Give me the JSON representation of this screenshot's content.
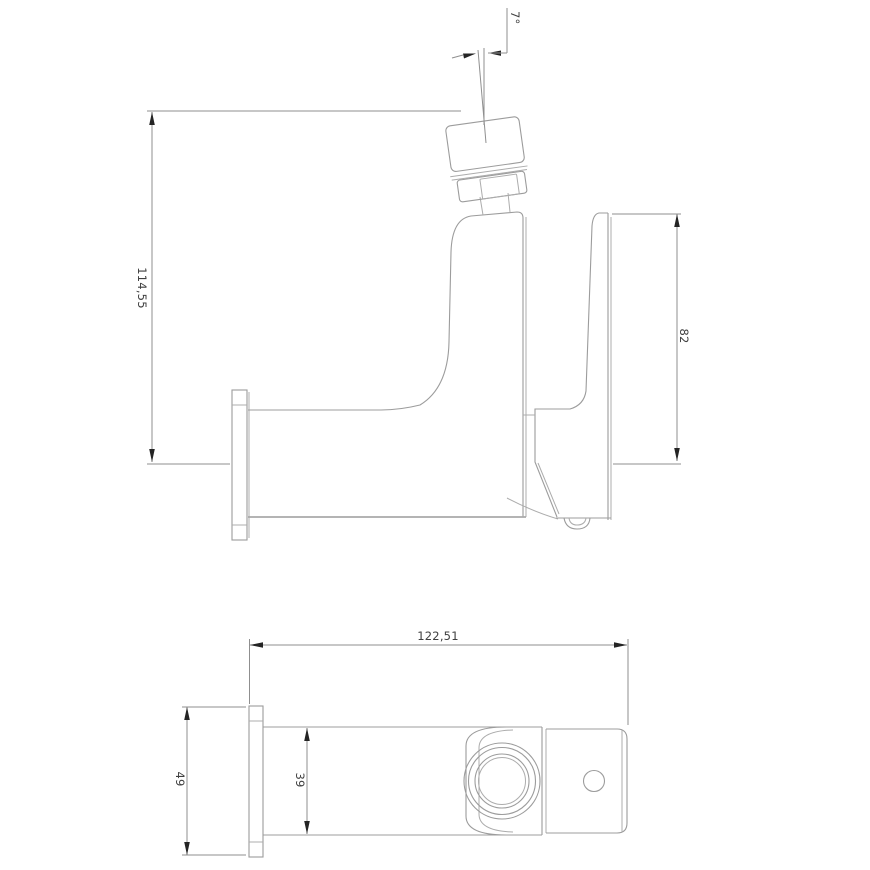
{
  "drawing": {
    "type": "technical-drawing-faucet",
    "colors": {
      "background": "#ffffff",
      "geometry_line": "#9c9c9c",
      "dimension_line": "#8f8f8f",
      "arrow": "#242424",
      "text": "#3f3f3f"
    },
    "side_view": {
      "overall_height": "114,55",
      "handle_height": "82",
      "aerator_angle": "7°"
    },
    "top_view": {
      "overall_length": "122,51",
      "flange_width": "49",
      "body_width": "39"
    }
  }
}
